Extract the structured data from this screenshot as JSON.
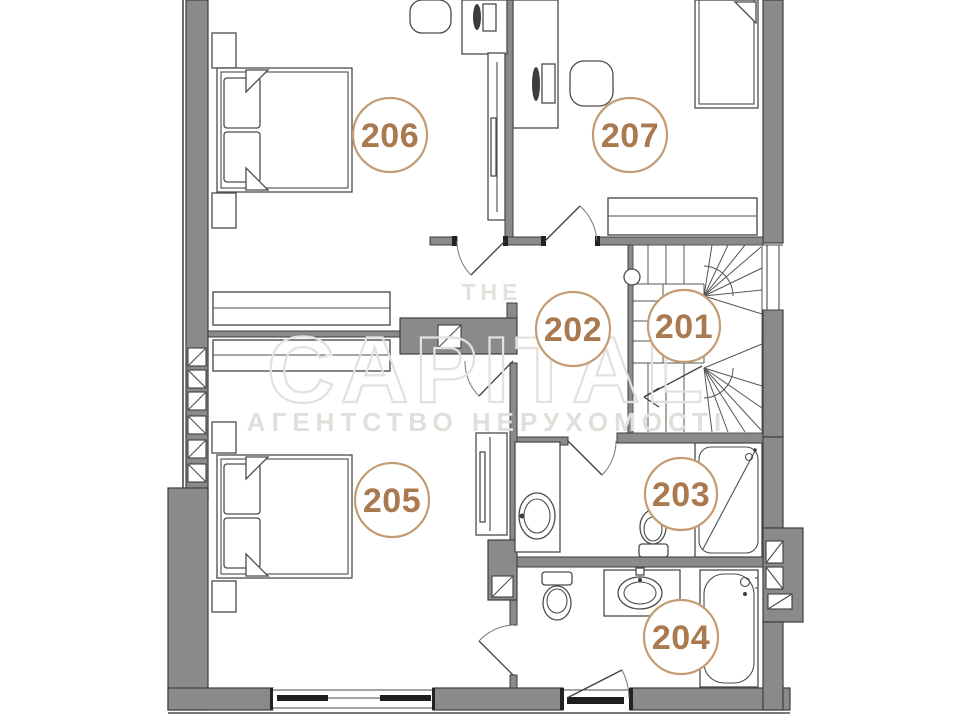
{
  "floorplan": {
    "room_labels": [
      {
        "number": "201"
      },
      {
        "number": "202"
      },
      {
        "number": "203"
      },
      {
        "number": "204"
      },
      {
        "number": "205"
      },
      {
        "number": "206"
      },
      {
        "number": "207"
      }
    ],
    "watermark": {
      "line_top": "THE",
      "brand": "CAPITAL",
      "tagline": "АГЕНТСТВО НЕРУХОМОСТІ"
    },
    "colors": {
      "wall_fill": "#8a8a8a",
      "wall_outline": "#3e3e3e",
      "label_text": "#a9794f",
      "label_ring": "#c49c74",
      "furniture_line": "#4c4c4c",
      "watermark": "#e4e0db"
    }
  }
}
